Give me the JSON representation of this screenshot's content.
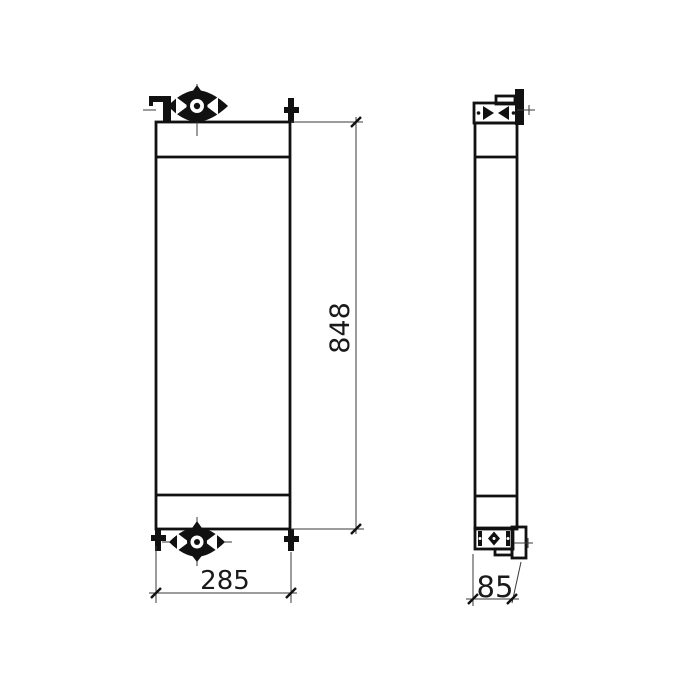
{
  "drawing": {
    "type": "orthographic technical drawing",
    "subject": "radiator / cooler core assembly, two views (front and side)",
    "background_color": "#ffffff",
    "line_color": "#111111",
    "dim_line_color": "#3a3a3a",
    "text_color": "#1a1a1a",
    "views": [
      {
        "name": "front-view",
        "description": "tall rectangle with top tank, core, bottom tank, filler cap top center, drain cap bottom center, pipe stubs at corners"
      },
      {
        "name": "side-view",
        "description": "narrow tall rectangle with cap blocks and mounting brackets top and bottom"
      }
    ],
    "dimensions": {
      "height": "848",
      "width": "285",
      "depth": "85"
    }
  }
}
